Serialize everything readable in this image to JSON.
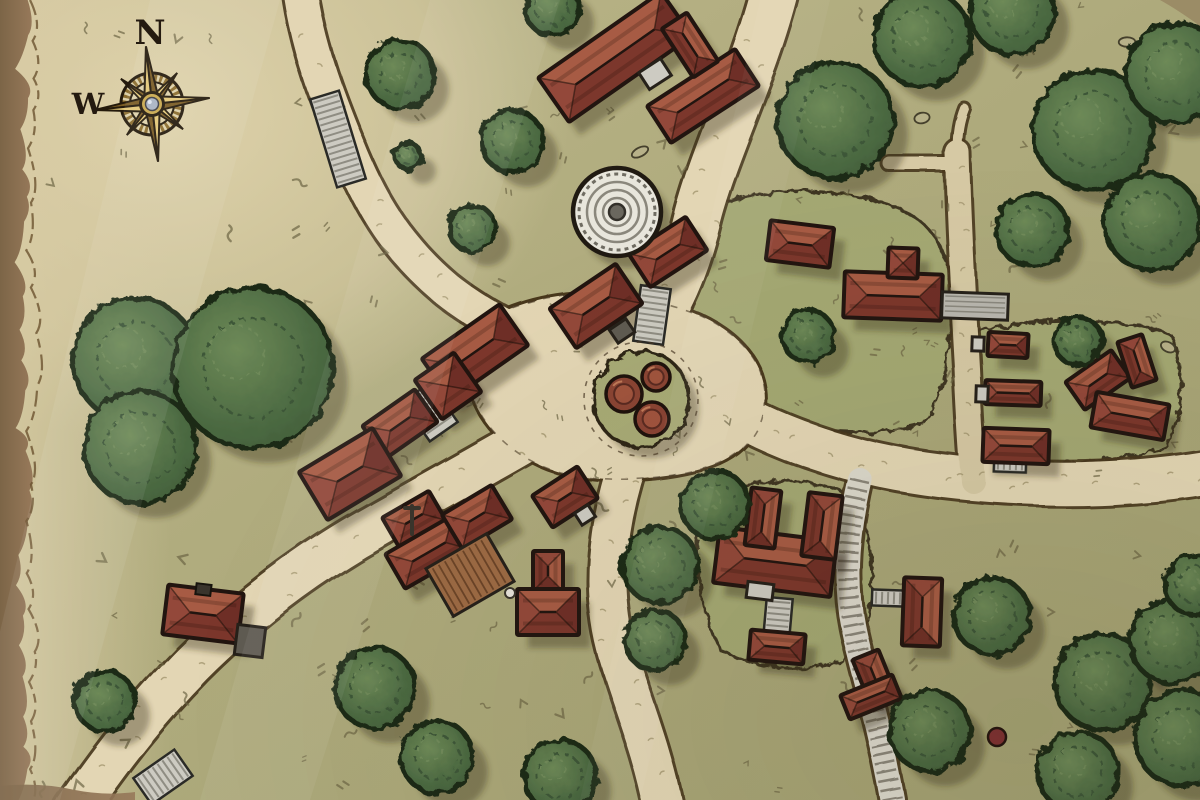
{
  "map": {
    "title": "hand-drawn village map",
    "compass": {
      "x": 152,
      "y": 104,
      "rot": -6,
      "labels": {
        "north": "N",
        "west": "W"
      }
    },
    "colors": {
      "ground": "#b2ad7f",
      "groundDark": "#a0a26f",
      "road": "#e3d6b4",
      "roadEdge": "#49391f",
      "parchment": "#ddd0a9",
      "borderBrown": "#8d7254",
      "borderLine": "#6b5330",
      "roofDark": "#7c372c",
      "roofLight": "#a75b44",
      "hipL": "#93483a",
      "hipR": "#6f2f27",
      "outline": "#221510",
      "treeFill": "#55724a",
      "treeDark": "#3c5737",
      "treeOutline": "#1c2916",
      "stoneLight": "#cdcbc2",
      "stoneMid": "#b9b7ae",
      "stoneDark": "#8f8d83",
      "wood": "#9c6a44",
      "woodLine": "#6b4428",
      "compassGold": "#c9a84e",
      "compassGoldLight": "#e3c878",
      "compassGoldDark": "#7a5c24",
      "compassInk": "#241a0c",
      "gem": "#a9b3c2",
      "mound": "#a4a873",
      "shadow": "rgba(58,48,26,0.38)",
      "grassMark": "#6c6544",
      "roadMark": "#a3966f"
    },
    "roads": [
      {
        "name": "northwest-road",
        "d": "M 300,-10 C 308,50 330,105 352,158 C 374,210 400,250 445,288 C 480,316 520,335 555,348",
        "w": 34,
        "type": "dirt"
      },
      {
        "name": "north-road",
        "d": "M 775,-10 C 755,70 715,150 698,215 C 688,258 672,300 650,330",
        "w": 46,
        "type": "dirt"
      },
      {
        "name": "east-road",
        "d": "M 695,390 C 770,438 850,465 940,476 C 1030,487 1120,487 1210,472",
        "w": 42,
        "type": "dirt"
      },
      {
        "name": "south-road",
        "d": "M 628,462 C 606,530 600,595 618,655 C 632,703 652,748 664,810",
        "w": 38,
        "type": "dirt"
      },
      {
        "name": "southwest-road",
        "d": "M 548,428 C 480,468 420,500 355,538 C 290,577 235,622 192,665 C 150,708 115,752 75,810",
        "w": 42,
        "type": "dirt"
      },
      {
        "name": "east-ridge-track",
        "d": "M 957,152 C 959,225 963,300 967,368 C 969,415 971,447 974,482",
        "w": 24,
        "type": "trail"
      },
      {
        "name": "forest-trail-stub",
        "d": "M 890,164 L 955,164",
        "w": 13,
        "type": "trail"
      },
      {
        "name": "forest-trail-tip",
        "d": "M 957,150 C 957,132 960,118 964,108",
        "w": 9,
        "type": "trail"
      },
      {
        "name": "southeast-cobbled-lane",
        "d": "M 860,480 C 849,528 843,577 853,627 C 862,672 878,716 893,800",
        "w": 24,
        "type": "cobbled"
      }
    ],
    "plaza": {
      "name": "central-plaza",
      "d": "M 470,330 C 520,295 590,285 650,300 C 710,312 752,340 762,380 C 772,420 750,455 705,468 C 655,482 585,485 540,465 C 495,445 455,400 470,330 Z"
    },
    "mounds": [
      {
        "name": "northeast-green",
        "d": "M 700,215 C 750,185 830,185 890,205 C 940,222 952,260 950,310 C 948,365 945,405 920,425 C 860,440 780,430 730,405 C 700,388 690,340 692,290 C 693,258 693,232 700,215 Z"
      },
      {
        "name": "east-green",
        "d": "M 972,332 C 1040,315 1130,318 1172,336 C 1186,380 1182,420 1166,448 C 1090,468 1020,466 984,456 C 968,415 966,368 972,332 Z"
      },
      {
        "name": "manor-green",
        "d": "M 702,498 C 760,472 830,478 860,502 C 878,560 874,625 856,652 C 820,676 760,672 720,650 C 698,610 692,540 702,498 Z"
      }
    ],
    "well": {
      "x": 617,
      "y": 212,
      "r": 44
    },
    "barrelMound": {
      "x": 641,
      "y": 399,
      "r": 48,
      "barrels": [
        [
          624,
          394,
          18
        ],
        [
          656,
          377,
          14
        ],
        [
          652,
          419,
          17
        ]
      ]
    },
    "buildings": [
      [
        615,
        57,
        150,
        54,
        -35
      ],
      [
        703,
        96,
        105,
        44,
        -33
      ],
      [
        690,
        45,
        30,
        58,
        -33
      ],
      [
        668,
        252,
        68,
        40,
        -33
      ],
      [
        596,
        306,
        80,
        48,
        -34
      ],
      [
        800,
        244,
        64,
        40,
        7
      ],
      [
        893,
        296,
        98,
        46,
        2
      ],
      [
        903,
        263,
        30,
        30,
        2
      ],
      [
        1008,
        345,
        40,
        24,
        3
      ],
      [
        1013,
        393,
        56,
        24,
        2
      ],
      [
        1016,
        446,
        66,
        34,
        2
      ],
      [
        1098,
        380,
        56,
        34,
        -35
      ],
      [
        1137,
        361,
        26,
        48,
        -18
      ],
      [
        1130,
        416,
        74,
        36,
        10
      ],
      [
        475,
        352,
        95,
        50,
        -35
      ],
      [
        448,
        386,
        48,
        48,
        -35
      ],
      [
        400,
        424,
        64,
        40,
        -35
      ],
      [
        350,
        474,
        86,
        56,
        -31
      ],
      [
        414,
        519,
        54,
        34,
        -30
      ],
      [
        429,
        552,
        78,
        40,
        -30
      ],
      [
        477,
        517,
        58,
        40,
        -31
      ],
      [
        565,
        497,
        54,
        38,
        -33
      ],
      [
        548,
        571,
        30,
        40,
        0
      ],
      [
        548,
        612,
        62,
        46,
        0
      ],
      [
        775,
        562,
        118,
        56,
        7
      ],
      [
        763,
        518,
        30,
        58,
        7
      ],
      [
        822,
        526,
        34,
        64,
        7
      ],
      [
        777,
        647,
        55,
        30,
        5
      ],
      [
        922,
        612,
        38,
        68,
        2
      ],
      [
        874,
        676,
        28,
        46,
        -22
      ],
      [
        871,
        697,
        56,
        26,
        -22
      ],
      [
        203,
        614,
        76,
        50,
        7
      ]
    ],
    "annexes": [
      [
        655,
        74,
        26,
        20,
        -33,
        "light"
      ],
      [
        585,
        515,
        16,
        14,
        -33,
        "light"
      ],
      [
        760,
        591,
        26,
        16,
        7,
        "light"
      ],
      [
        975,
        306,
        66,
        26,
        2,
        "stone"
      ],
      [
        978,
        344,
        12,
        14,
        2,
        "light"
      ],
      [
        982,
        394,
        12,
        16,
        2,
        "light"
      ],
      [
        250,
        641,
        28,
        30,
        7,
        "dark"
      ],
      [
        622,
        331,
        20,
        16,
        -34,
        "dark"
      ],
      [
        470,
        575,
        70,
        55,
        -30,
        "wood"
      ]
    ],
    "stairs": [
      [
        338,
        139,
        30,
        92,
        -17
      ],
      [
        652,
        315,
        30,
        56,
        8
      ],
      [
        430,
        412,
        34,
        48,
        -35
      ],
      [
        463,
        526,
        18,
        30,
        -30
      ],
      [
        778,
        618,
        26,
        40,
        5
      ],
      [
        888,
        598,
        32,
        16,
        2
      ],
      [
        163,
        777,
        50,
        32,
        -35
      ],
      [
        1010,
        465,
        32,
        14,
        2
      ]
    ],
    "signpost": {
      "x": 412,
      "y": 520
    },
    "trees": [
      [
        400,
        74,
        34
      ],
      [
        512,
        141,
        31
      ],
      [
        472,
        228,
        23
      ],
      [
        408,
        156,
        13
      ],
      [
        552,
        8,
        27
      ],
      [
        835,
        120,
        58
      ],
      [
        922,
        38,
        48
      ],
      [
        1012,
        12,
        42
      ],
      [
        1093,
        130,
        60
      ],
      [
        1176,
        73,
        50
      ],
      [
        1152,
        222,
        48
      ],
      [
        1032,
        230,
        36
      ],
      [
        808,
        336,
        26
      ],
      [
        1078,
        341,
        24
      ],
      [
        135,
        360,
        62
      ],
      [
        253,
        368,
        80
      ],
      [
        140,
        447,
        56
      ],
      [
        375,
        688,
        40
      ],
      [
        437,
        757,
        36
      ],
      [
        105,
        701,
        30
      ],
      [
        560,
        776,
        36
      ],
      [
        655,
        640,
        30
      ],
      [
        715,
        505,
        34
      ],
      [
        660,
        565,
        38
      ],
      [
        930,
        731,
        40
      ],
      [
        992,
        616,
        38
      ],
      [
        1103,
        682,
        48
      ],
      [
        1172,
        641,
        42
      ],
      [
        1183,
        738,
        48
      ],
      [
        1078,
        772,
        40
      ],
      [
        1195,
        585,
        30
      ]
    ],
    "berry": [
      997,
      737,
      9
    ],
    "rocks": [
      [
        545,
        18
      ],
      [
        1127,
        42
      ],
      [
        922,
        118
      ],
      [
        640,
        152
      ],
      [
        700,
        120
      ],
      [
        1168,
        347
      ]
    ]
  }
}
